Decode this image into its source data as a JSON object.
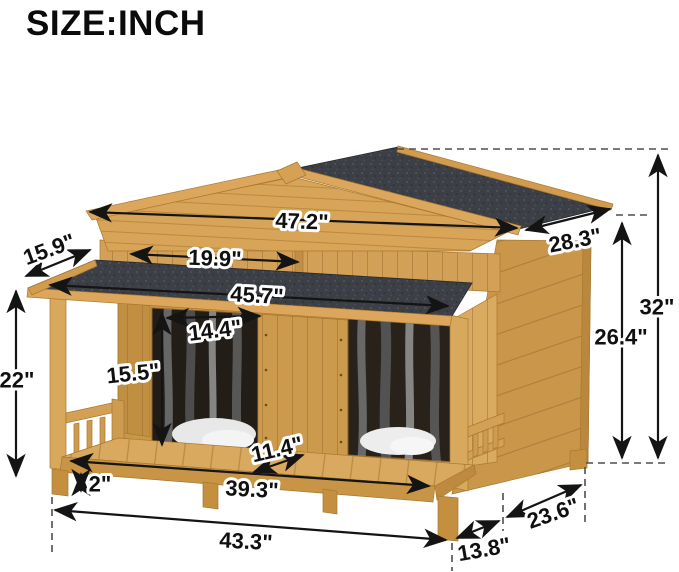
{
  "page": {
    "title": "SIZE:INCH"
  },
  "diagram": {
    "subject": "Wooden dog house with covered front porch, asphalt-felt gable roof, two curtained doorways and railings",
    "unit": "inch",
    "colors": {
      "wood_light": "#dcab61",
      "wood_mid": "#cf9d52",
      "wood_dark": "#c08f45",
      "roof_felt": "#3c3f45",
      "dimension_line": "#141414",
      "background": "#ffffff"
    },
    "dims": {
      "roof_width": "47.2\"",
      "roof_panel_depth": "28.3\"",
      "porch_roof_overhang_depth": "15.9\"",
      "left_roof_section_width": "19.9\"",
      "porch_roof_width": "45.7\"",
      "door_opening_width": "14.4\"",
      "door_opening_height": "15.5\"",
      "porch_eave_height": "22\"",
      "floor_ground_clearance": "2\"",
      "doorway_floor_depth": "11.4\"",
      "porch_floor_width": "39.3\"",
      "overall_width": "43.3\"",
      "porch_depth": "13.8\"",
      "house_depth": "23.6\"",
      "side_wall_height": "26.4\"",
      "overall_height": "32\""
    }
  }
}
